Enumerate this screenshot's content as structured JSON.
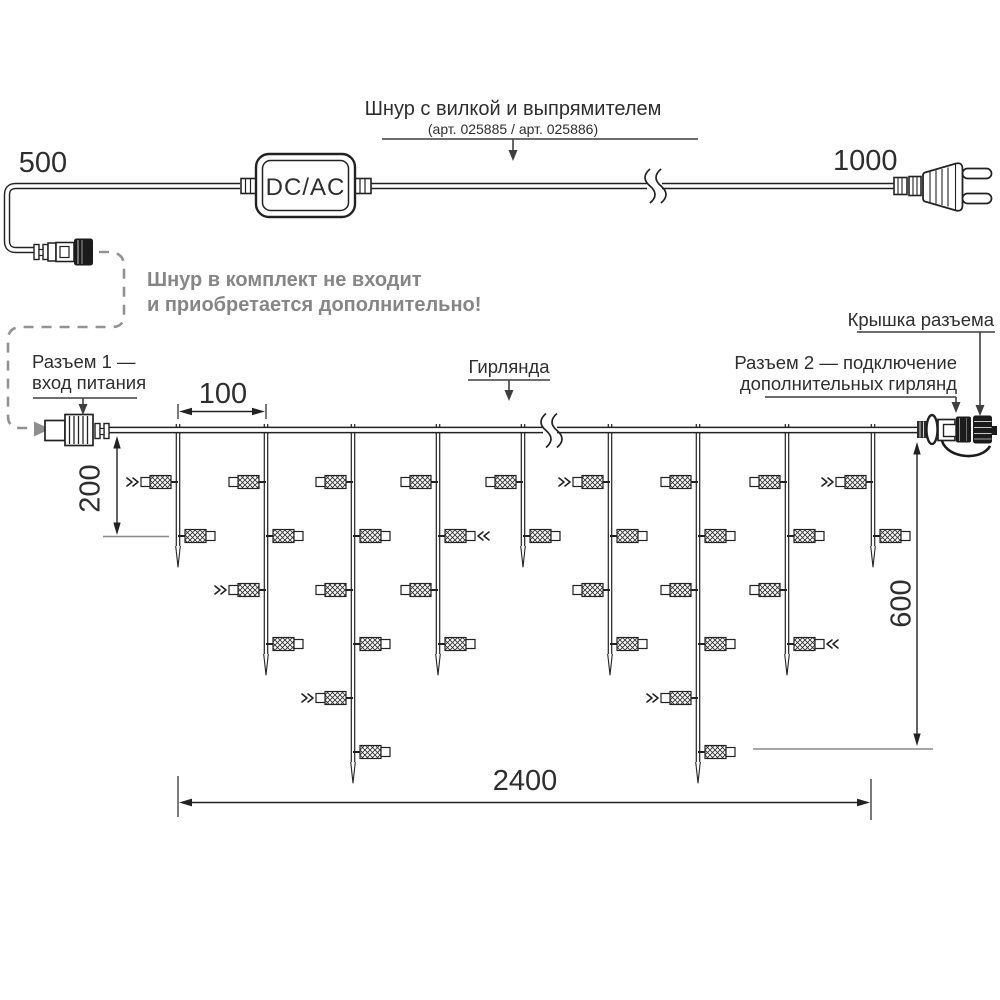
{
  "power_cord": {
    "title": "Шнур с вилкой и выпрямителем",
    "subtitle": "(арт. 025885 /  арт. 025886)",
    "length_left": "500",
    "length_right": "1000",
    "converter_label": "DC/AC",
    "note_line1": "Шнур в комплект не входит",
    "note_line2": "и приобретается дополнительно!"
  },
  "garland": {
    "label": "Гирлянда",
    "connector1_line1": "Разъем 1 —",
    "connector1_line2": "вход питания",
    "connector2_line1": "Разъем 2 — подключение",
    "connector2_line2": "дополнительных гирлянд",
    "cap_label": "Крышка разъема",
    "dims": {
      "drop_spacing": "100",
      "first_drop": "200",
      "height": "600",
      "length": "2400"
    },
    "drops": [
      {
        "x": 178,
        "lamps": 2,
        "flash": [
          1
        ]
      },
      {
        "x": 266,
        "lamps": 4,
        "flash": [
          3
        ]
      },
      {
        "x": 353,
        "lamps": 6,
        "flash": [
          5
        ]
      },
      {
        "x": 438,
        "lamps": 4,
        "flash": [
          2
        ]
      },
      {
        "x": 523,
        "lamps": 2,
        "flash": []
      },
      {
        "x": 610,
        "lamps": 4,
        "flash": [
          1
        ]
      },
      {
        "x": 698,
        "lamps": 6,
        "flash": [
          5
        ]
      },
      {
        "x": 787,
        "lamps": 4,
        "flash": [
          4
        ]
      },
      {
        "x": 873,
        "lamps": 2,
        "flash": [
          1
        ]
      }
    ]
  },
  "colors": {
    "line": "#222222",
    "leader": "#3f3f3f",
    "muted_gray": "#8f8f8f",
    "ext_gray": "#8a8a8a",
    "note_text": "#868686",
    "black_part": "#1b1b1b"
  }
}
